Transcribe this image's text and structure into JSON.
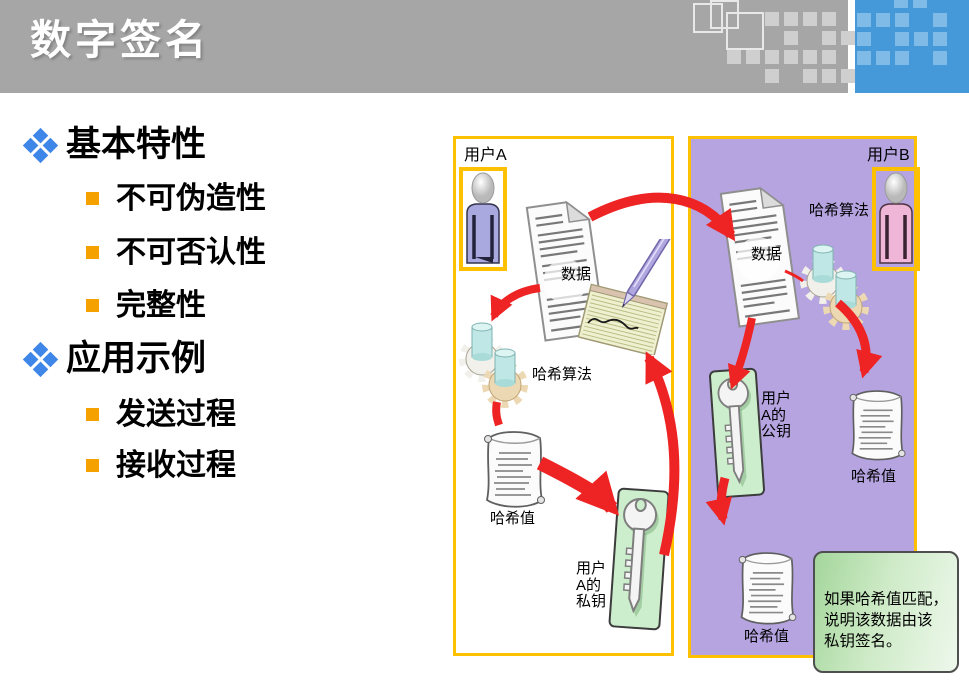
{
  "header": {
    "title": "数字签名"
  },
  "outline": {
    "items": [
      {
        "label": "基本特性",
        "children": [
          "不可伪造性",
          "不可否认性",
          "完整性"
        ]
      },
      {
        "label": "应用示例",
        "children": [
          "发送过程",
          "接收过程"
        ]
      }
    ]
  },
  "diagram": {
    "panel_a": {
      "user": "用户A",
      "doc_label": "数据",
      "hash_algo": "哈希算法",
      "hash_value": "哈希值",
      "key_lines": [
        "用户",
        "A的",
        "私钥"
      ]
    },
    "panel_b": {
      "user": "用户B",
      "hash_algo": "哈希算法",
      "doc_label": "数据",
      "key_lines": [
        "用户",
        "A的",
        "公钥"
      ],
      "hash_value_top": "哈希值",
      "hash_value_bottom": "哈希值"
    },
    "note_lines": [
      "如果哈希值匹配，",
      "说明该数据由该",
      "私钥签名。"
    ]
  },
  "colors": {
    "header_gray": "#a6a6a6",
    "header_blue": "#4599d9",
    "accent_border": "#ffc000",
    "panel_purple": "#b5a4e0",
    "arrow_red": "#ee2424",
    "bullet_blue": "#3e86e8",
    "bullet_orange": "#f5a200",
    "note_green": "#bfe3b8",
    "key_card_green": "#cdeecd"
  }
}
